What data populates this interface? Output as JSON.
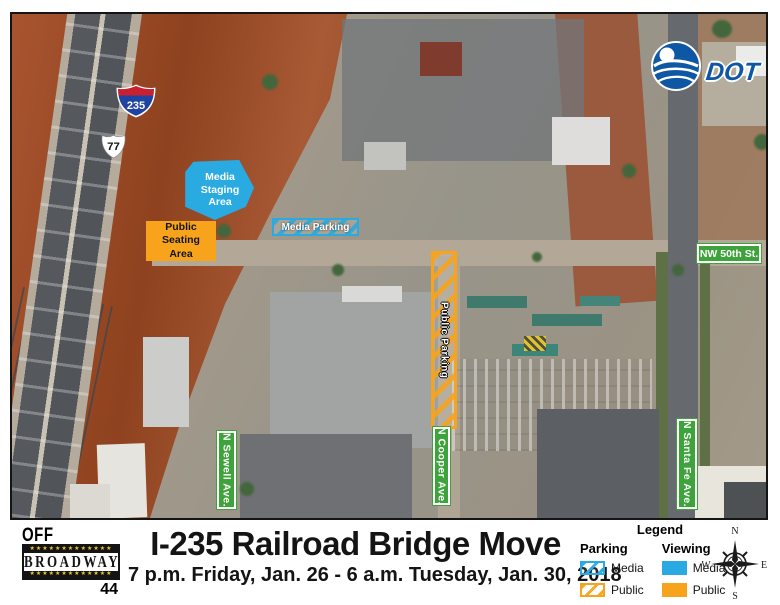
{
  "map": {
    "shield_interstate": "235",
    "shield_us": "77",
    "overlay_media_staging": "Media\nStaging\nArea",
    "overlay_public_seating": "Public\nSeating\nArea",
    "overlay_media_parking": "Media Parking",
    "overlay_public_parking": "Public Parking",
    "sign_nw_50th": "NW 50th St.",
    "sign_sewell": "N Sewell Ave.",
    "sign_cooper": "N Cooper Ave.",
    "sign_santa_fe": "N Santa Fe Ave.",
    "odot_logo_text": "DOT"
  },
  "footer": {
    "title": "I-235 Railroad Bridge Move",
    "subtitle": "7 p.m. Friday, Jan. 26 - 6 a.m. Tuesday, Jan. 30, 2018",
    "off_broadway": {
      "line1": "OFF",
      "name": "BROADWAY",
      "number": "44",
      "stars": "★★★★★★★★★★★★★"
    }
  },
  "legend": {
    "title": "Legend",
    "columns": [
      {
        "header": "Parking",
        "items": [
          {
            "label": "Media",
            "style": "hatched-blue"
          },
          {
            "label": "Public",
            "style": "hatched-orange"
          }
        ]
      },
      {
        "header": "Viewing",
        "items": [
          {
            "label": "Media",
            "style": "solid-blue"
          },
          {
            "label": "Public",
            "style": "solid-orange"
          }
        ]
      }
    ],
    "compass": {
      "north": "N",
      "east": "E",
      "south": "S",
      "west": "W"
    }
  },
  "colors": {
    "media_blue": "#29ABE2",
    "public_orange": "#F7A41C",
    "sign_green": "#3FA33C",
    "odot_blue": "#0E57A5",
    "interstate_red": "#C8202E",
    "interstate_blue": "#1F43A0"
  }
}
